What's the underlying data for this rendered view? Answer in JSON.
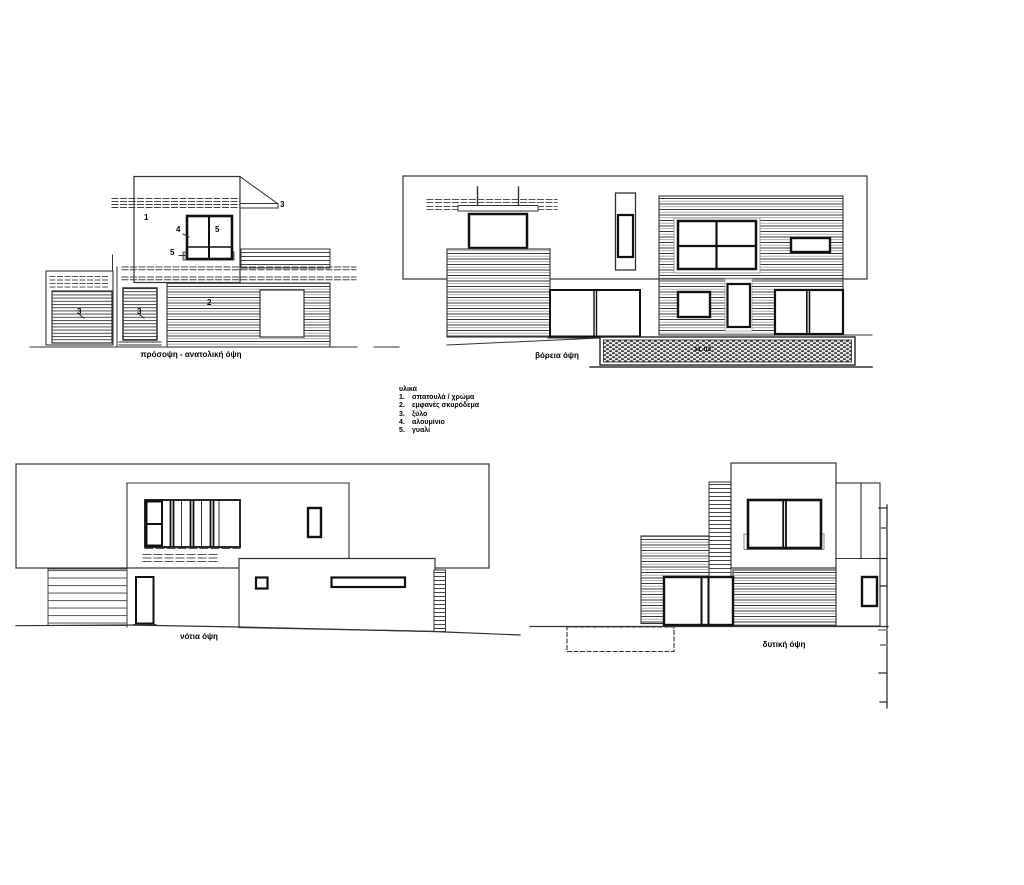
{
  "sheet": {
    "background": "#ffffff",
    "ink": "#333333"
  },
  "legend": {
    "title": "υλικά",
    "items": [
      {
        "num": "1.",
        "label": "σπατουλά / χρώμα"
      },
      {
        "num": "2.",
        "label": "εμφανές σκυρόδεμα"
      },
      {
        "num": "3.",
        "label": "ξύλο"
      },
      {
        "num": "4.",
        "label": "αλουμίνιο"
      },
      {
        "num": "5.",
        "label": "γυαλί"
      }
    ]
  },
  "elevations": {
    "east": {
      "title": "πρόσοψη - ανατολική όψη",
      "callouts": [
        {
          "n": "1"
        },
        {
          "n": "4"
        },
        {
          "n": "5"
        },
        {
          "n": "5"
        },
        {
          "n": "3"
        },
        {
          "n": "2"
        },
        {
          "n": "3"
        },
        {
          "n": "3"
        }
      ]
    },
    "north": {
      "title": "βόρεια όψη",
      "level_note": "11.02"
    },
    "south": {
      "title": "νότια όψη"
    },
    "west": {
      "title": "δυτική όψη"
    }
  }
}
